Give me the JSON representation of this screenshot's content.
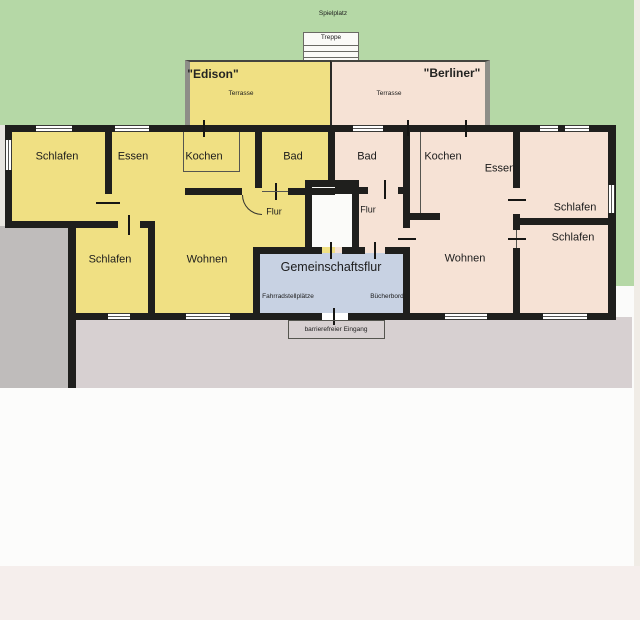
{
  "site": {
    "spielplatz": "Spielplatz",
    "treppe": "Treppe",
    "barrier_free_entrance": "barrierefreier Eingang"
  },
  "shared": {
    "hall": "Gemeinschaftsflur",
    "bike_parking": "Fahrradstellplätze",
    "bookshelf": "Bücherbord"
  },
  "edison": {
    "name": "\"Edison\"",
    "terrace": "Terrasse",
    "schlafen1": "Schlafen",
    "essen": "Essen",
    "kochen": "Kochen",
    "bad": "Bad",
    "flur": "Flur",
    "schlafen2": "Schlafen",
    "wohnen": "Wohnen"
  },
  "berliner": {
    "name": "\"Berliner\"",
    "terrace": "Terrasse",
    "bad": "Bad",
    "kochen": "Kochen",
    "essen": "Essen",
    "flur": "Flur",
    "wohnen": "Wohnen",
    "schlafen1": "Schlafen",
    "schlafen2": "Schlafen"
  },
  "colors": {
    "lawn": "#b5d8a6",
    "edison_fill": "#f0e083",
    "berliner_fill": "#f6e2d5",
    "shared_hall_fill": "#c8d2e3",
    "vestibule_fill": "#fbfbf9",
    "pavement_grey": "#bfbcbb",
    "pavement_mauve": "#d7d0d1",
    "paper_white": "#fbfbfa",
    "bottom_strip": "#f5eeec",
    "wall": "#1f1f1d",
    "terrace_border": "#8e8e88"
  }
}
